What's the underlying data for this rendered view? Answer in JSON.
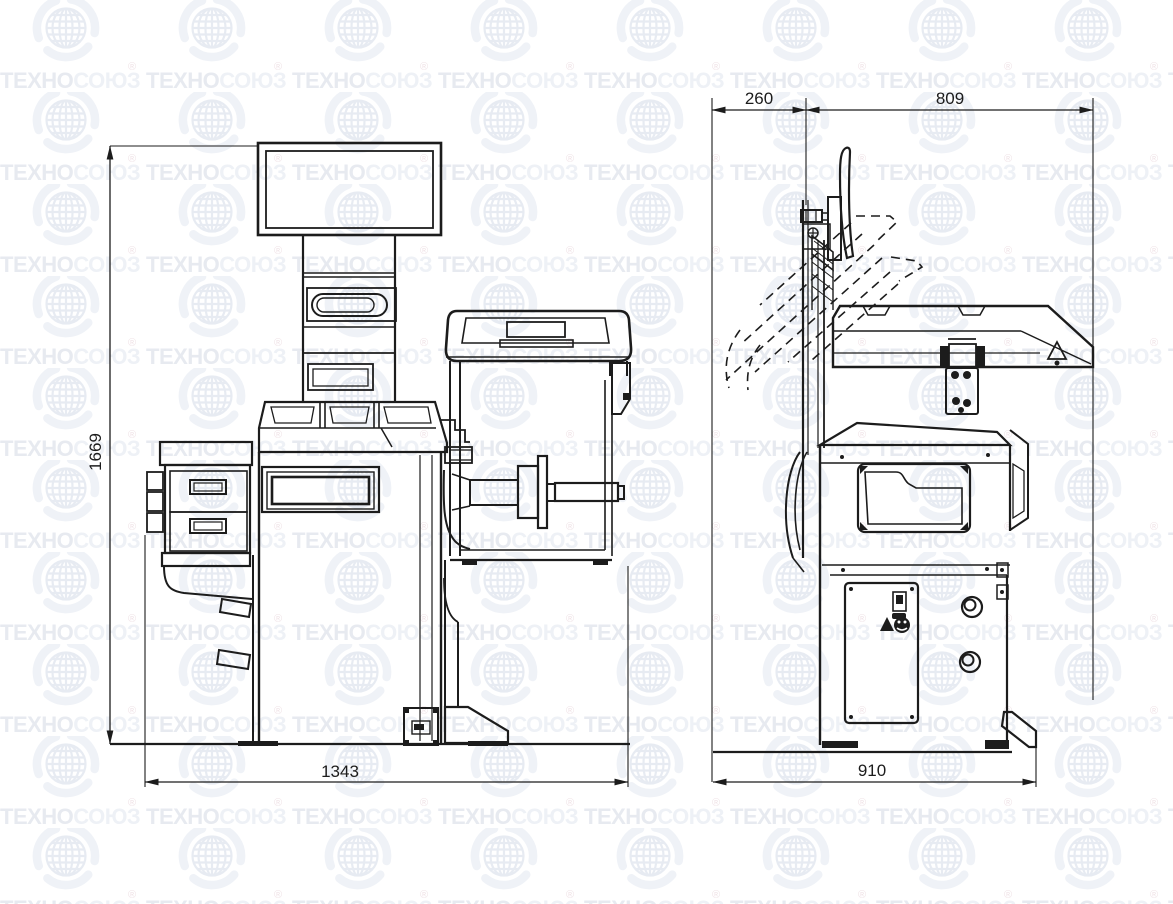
{
  "page": {
    "kind": "technical dimensional drawing",
    "subject": "wheel balancer machine, front and side orthographic views"
  },
  "colors": {
    "ink": "#1c1c1c",
    "background": "#ffffff",
    "wm_prefix": "#e7eaf0",
    "wm_suffix": "#eef1f6",
    "wm_mark": "#f0e3e7",
    "wm_globe": "#e7ebf2",
    "wm_swirl": "#eff2f7"
  },
  "watermark": {
    "brand_prefix": "ТЕХНО",
    "brand_suffix": "СОЮЗ",
    "registered_mark": "®",
    "globe_icon": "globe-in-swirl-logo"
  },
  "views": {
    "front": {
      "label": "front view (machine with monitor, weight tray, drawers, spindle, wheel guard)"
    },
    "side": {
      "label": "side view (rear column, raised-hood dashed outline, shelf, cabinet, pedal)"
    }
  },
  "dimensions": {
    "height": {
      "value": "1669",
      "orientation": "vertical",
      "view": "front"
    },
    "width": {
      "value": "1343",
      "orientation": "horizontal",
      "view": "front"
    },
    "rear_clearance": {
      "value": "260",
      "orientation": "horizontal",
      "view": "side"
    },
    "upper_depth": {
      "value": "809",
      "orientation": "horizontal",
      "view": "side"
    },
    "base_depth": {
      "value": "910",
      "orientation": "horizontal",
      "view": "side"
    }
  }
}
